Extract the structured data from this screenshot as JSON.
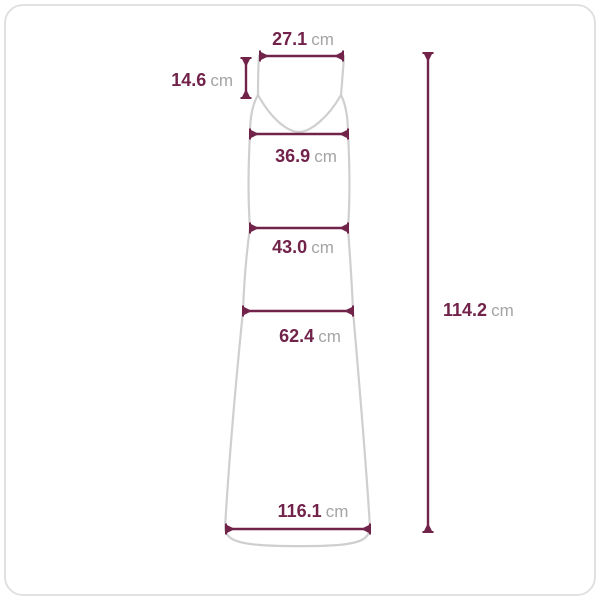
{
  "colors": {
    "accent": "#71234a",
    "unit-text": "#a4a4a4",
    "outline": "#cfcfcf",
    "border": "#dedede",
    "background": "#ffffff"
  },
  "measurements": {
    "top_width": {
      "value": "27.1",
      "unit": "cm"
    },
    "strap_drop": {
      "value": "14.6",
      "unit": "cm"
    },
    "bust": {
      "value": "36.9",
      "unit": "cm"
    },
    "waist": {
      "value": "43.0",
      "unit": "cm"
    },
    "hip": {
      "value": "62.4",
      "unit": "cm"
    },
    "hem": {
      "value": "116.1",
      "unit": "cm"
    },
    "length": {
      "value": "114.2",
      "unit": "cm"
    }
  }
}
